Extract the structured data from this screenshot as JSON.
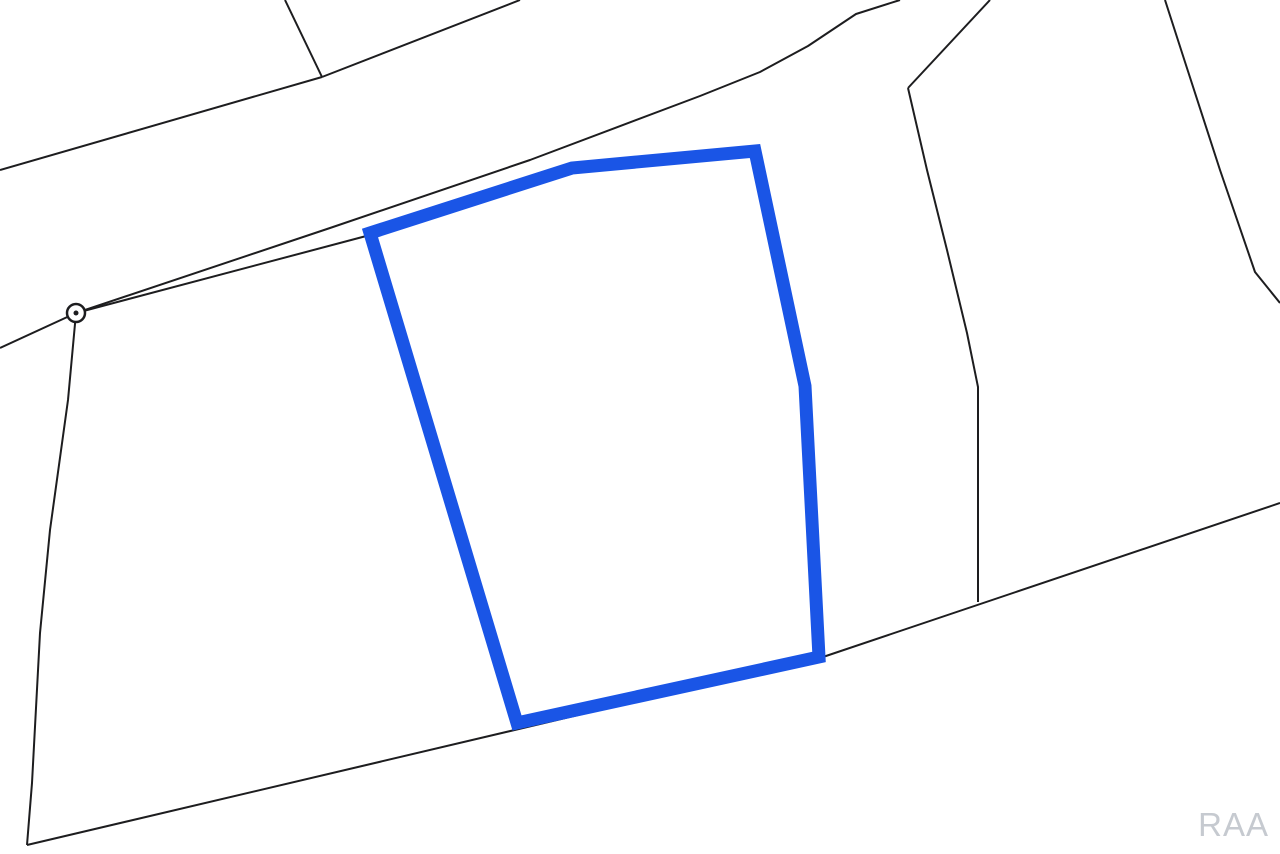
{
  "watermark": {
    "text": "RAA"
  },
  "colors": {
    "background": "#ffffff",
    "boundary": "#1d1d1f",
    "parcel_highlight": "#1a55e6",
    "marker_fill": "#ffffff",
    "watermark": "#c6cad0"
  },
  "map": {
    "type": "parcel-plat-map",
    "canvas": {
      "width": 1280,
      "height": 854
    },
    "highlighted_parcel": {
      "stroke_width": 13,
      "points": [
        [
          370,
          233
        ],
        [
          572,
          168
        ],
        [
          755,
          151
        ],
        [
          805,
          386
        ],
        [
          819,
          657
        ],
        [
          517,
          723
        ]
      ]
    },
    "boundary_stroke_width": 2,
    "boundary_lines": [
      {
        "name": "road-upper-edge",
        "points": [
          [
            0,
            348
          ],
          [
            76,
            313
          ],
          [
            330,
            228
          ],
          [
            530,
            160
          ],
          [
            700,
            96
          ],
          [
            760,
            72
          ],
          [
            808,
            46
          ],
          [
            856,
            14
          ],
          [
            900,
            0
          ]
        ]
      },
      {
        "name": "road-lower-edge",
        "points": [
          [
            76,
            313
          ],
          [
            370,
            235
          ]
        ]
      },
      {
        "name": "road-lower-edge-north",
        "points": [
          [
            990,
            0
          ],
          [
            908,
            88
          ]
        ]
      },
      {
        "name": "middle-parcel-boundary",
        "points": [
          [
            908,
            88
          ],
          [
            927,
            170
          ],
          [
            947,
            250
          ],
          [
            967,
            333
          ],
          [
            978,
            387
          ],
          [
            978,
            602
          ]
        ]
      },
      {
        "name": "rear-boundary-diagonal",
        "points": [
          [
            27,
            845
          ],
          [
            820,
            658
          ],
          [
            1280,
            503
          ]
        ]
      },
      {
        "name": "west-boundary",
        "points": [
          [
            76,
            313
          ],
          [
            68,
            400
          ],
          [
            50,
            530
          ],
          [
            40,
            633
          ],
          [
            32,
            783
          ],
          [
            27,
            845
          ]
        ]
      },
      {
        "name": "north-spur-left",
        "points": [
          [
            285,
            0
          ],
          [
            322,
            77
          ]
        ]
      },
      {
        "name": "north-spur-right",
        "points": [
          [
            322,
            77
          ],
          [
            520,
            0
          ]
        ]
      },
      {
        "name": "northwest-boundary",
        "points": [
          [
            322,
            77
          ],
          [
            0,
            170
          ]
        ]
      },
      {
        "name": "east-parcel-boundary",
        "points": [
          [
            1165,
            0
          ],
          [
            1185,
            62
          ],
          [
            1220,
            170
          ],
          [
            1255,
            272
          ],
          [
            1280,
            303
          ]
        ]
      }
    ],
    "survey_marker": {
      "cx": 76,
      "cy": 313,
      "outer_radius": 9,
      "outer_stroke_width": 2.5,
      "inner_radius": 2.5
    }
  }
}
